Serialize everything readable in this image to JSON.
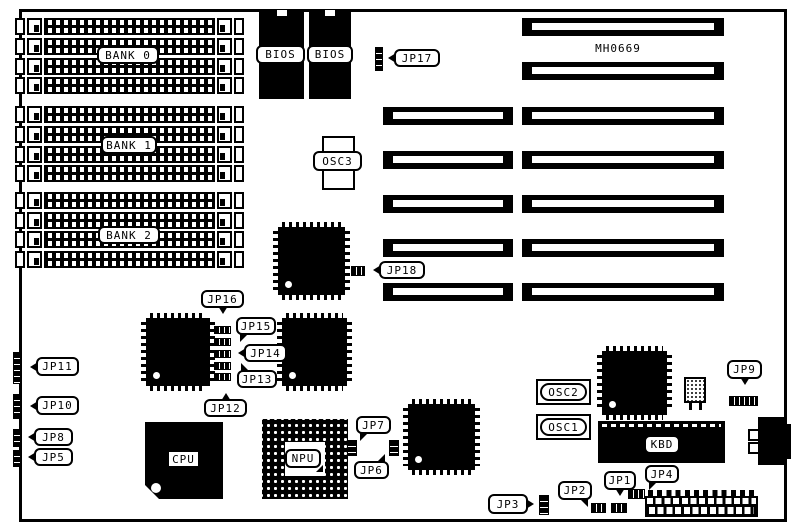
{
  "board": {
    "model": "MH0669"
  },
  "banks": [
    {
      "label": "BANK 0"
    },
    {
      "label": "BANK 1"
    },
    {
      "label": "BANK 2"
    }
  ],
  "chips": {
    "bios_left": "BIOS",
    "bios_right": "BIOS",
    "cpu": "CPU",
    "npu": "NPU",
    "kbd": "KBD"
  },
  "oscillators": {
    "osc1": "OSC1",
    "osc2": "OSC2",
    "osc3": "OSC3"
  },
  "jumpers": {
    "jp1": "JP1",
    "jp2": "JP2",
    "jp3": "JP3",
    "jp4": "JP4",
    "jp5": "JP5",
    "jp6": "JP6",
    "jp7": "JP7",
    "jp8": "JP8",
    "jp9": "JP9",
    "jp10": "JP10",
    "jp11": "JP11",
    "jp12": "JP12",
    "jp13": "JP13",
    "jp14": "JP14",
    "jp15": "JP15",
    "jp16": "JP16",
    "jp17": "JP17",
    "jp18": "JP18"
  }
}
